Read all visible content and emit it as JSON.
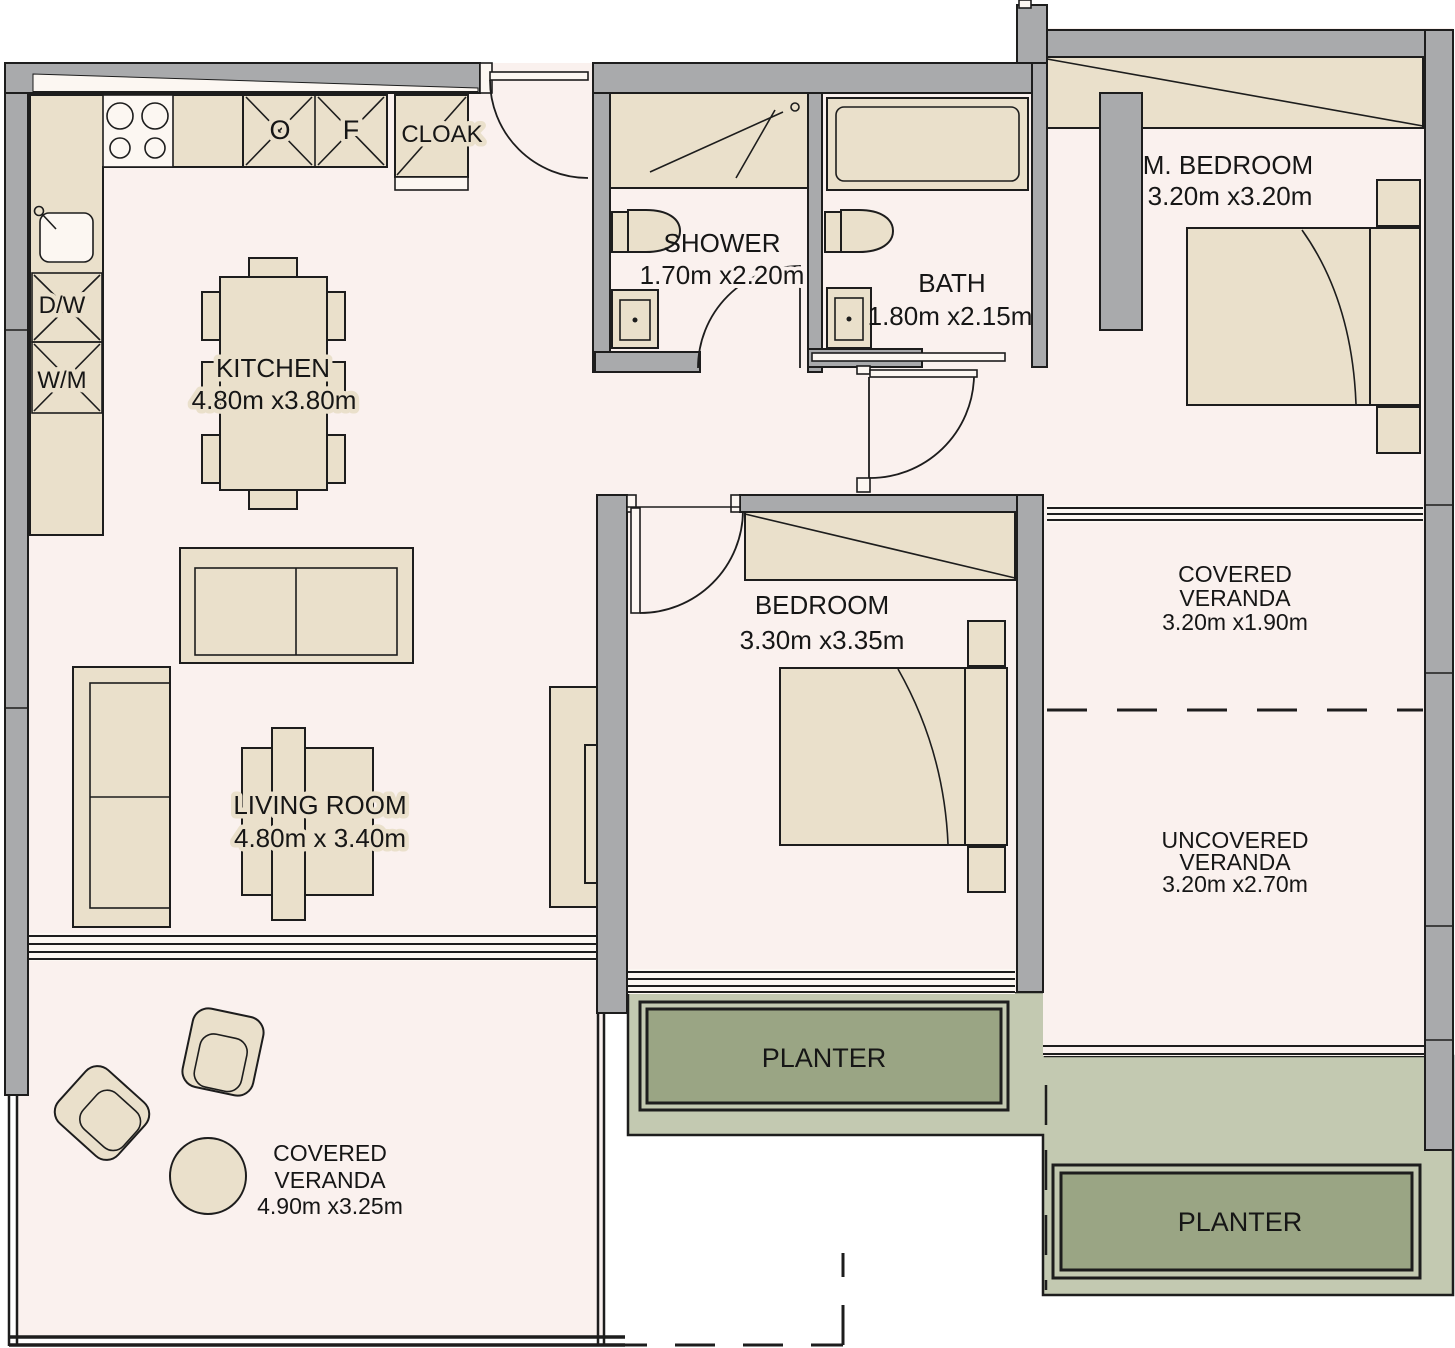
{
  "title": "Apartment floor plan",
  "colors": {
    "floor": "#faf1ee",
    "wall": "#a9aaac",
    "furniture": "#eae0cb",
    "line": "#1d1d1d",
    "green_area": "#c3c9b1",
    "planter_fill": "#9aa584",
    "fixture_white": "#fcf7f2",
    "background": "#ffffff"
  },
  "rooms": {
    "kitchen": {
      "label": "KITCHEN",
      "dims": "4.80m x3.80m"
    },
    "living_room": {
      "label": "LIVING ROOM",
      "dims": "4.80m x 3.40m"
    },
    "shower": {
      "label": "SHOWER",
      "dims": "1.70m x2.20m"
    },
    "bath": {
      "label": "BATH",
      "dims": "1.80m x2.15m"
    },
    "master_bedroom": {
      "label": "M. BEDROOM",
      "dims": "3.20m x3.20m"
    },
    "bedroom": {
      "label": "BEDROOM",
      "dims": "3.30m x3.35m"
    },
    "covered_veranda_right": {
      "label_line1": "COVERED",
      "label_line2": "VERANDA",
      "dims": "3.20m x1.90m"
    },
    "uncovered_veranda": {
      "label_line1": "UNCOVERED",
      "label_line2": "VERANDA",
      "dims": "3.20m x2.70m"
    },
    "covered_veranda_bottom": {
      "label_line1": "COVERED",
      "label_line2": "VERANDA",
      "dims": "4.90m x3.25m"
    },
    "cloak": {
      "label": "CLOAK"
    }
  },
  "fixtures": {
    "dishwasher": "D/W",
    "washing_machine": "W/M",
    "oven": "O",
    "fridge": "F",
    "planter_1": "PLANTER",
    "planter_2": "PLANTER"
  }
}
